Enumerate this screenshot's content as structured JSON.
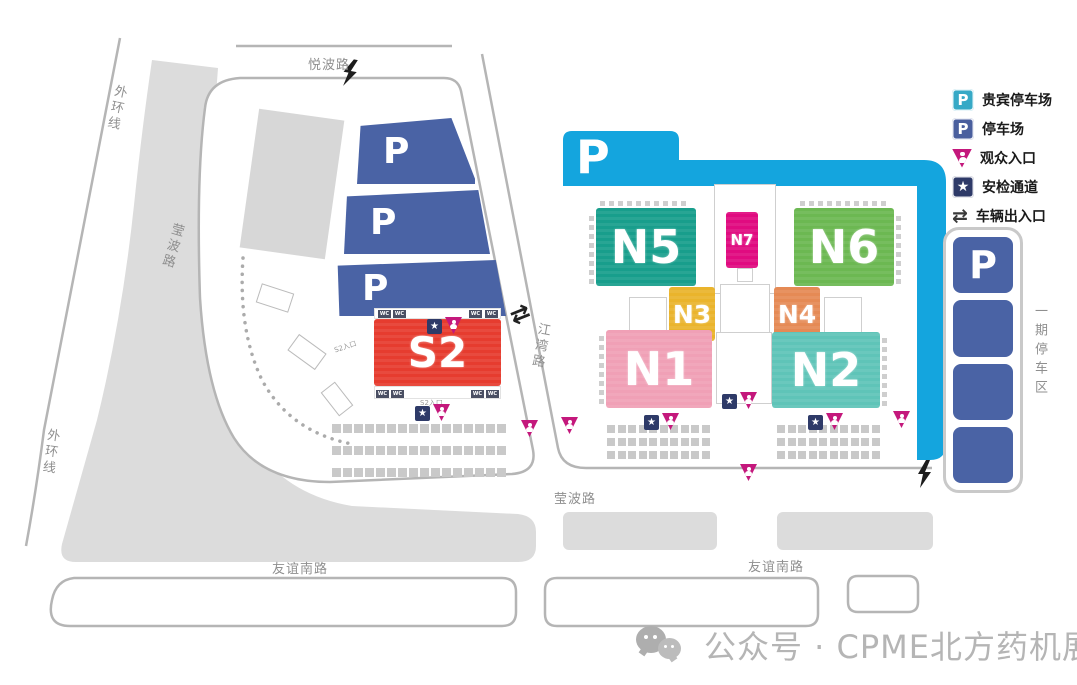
{
  "roads": {
    "yuebo_road": "悦波路",
    "outer_ring_top": "外环线",
    "outer_ring_bottom": "外环线",
    "yingbo_road_west": "莹波路",
    "jiangwan_road": "江湾路",
    "yingbo_road_south": "莹波路",
    "youyi_south_road_west": "友谊南路",
    "youyi_south_road_east": "友谊南路",
    "phase1_parking_zone": "一期停车区"
  },
  "halls": {
    "n5": "N5",
    "n7": "N7",
    "n6": "N6",
    "n3": "N3",
    "n4": "N4",
    "n1": "N1",
    "n2": "N2",
    "s2": "S2"
  },
  "parking": {
    "letter": "P"
  },
  "facility_labels": {
    "wc": "WC",
    "s2_entrance_west": "S2入口",
    "s2_entrance_south": "S2入口"
  },
  "icons": {
    "star": "★",
    "arrows": "⇄"
  },
  "legend": {
    "items": [
      {
        "id": "vip-parking",
        "label": "贵宾停车场"
      },
      {
        "id": "parking",
        "label": "停车场"
      },
      {
        "id": "visitor-entrance",
        "label": "观众入口"
      },
      {
        "id": "security-channel",
        "label": "安检通道"
      },
      {
        "id": "vehicle-gate",
        "label": "车辆出入口"
      }
    ]
  },
  "watermark": {
    "text": "公众号 · CPME北方药机展"
  },
  "colors": {
    "vip_band_cyan": "#14a5de",
    "parking_blue": "#4a63a5",
    "visitor_pink": "#c4187c",
    "security_navy": "#2e3a68",
    "n5": "#189e8c",
    "n6": "#6cb852",
    "n7": "#e00b80",
    "n3": "#eab42c",
    "n4": "#e58a55",
    "n1": "#f0a0b6",
    "n2": "#5fc4b8",
    "s2": "#e63c2f",
    "road_line": "#b5b5b5",
    "road_fill": "#dcdcdc"
  },
  "grids": {
    "s2_lot": {
      "rows": 3,
      "cols": 16
    },
    "n1_lot": {
      "rows": 3,
      "cols": 10
    },
    "n2_lot": {
      "rows": 3,
      "cols": 10
    }
  }
}
